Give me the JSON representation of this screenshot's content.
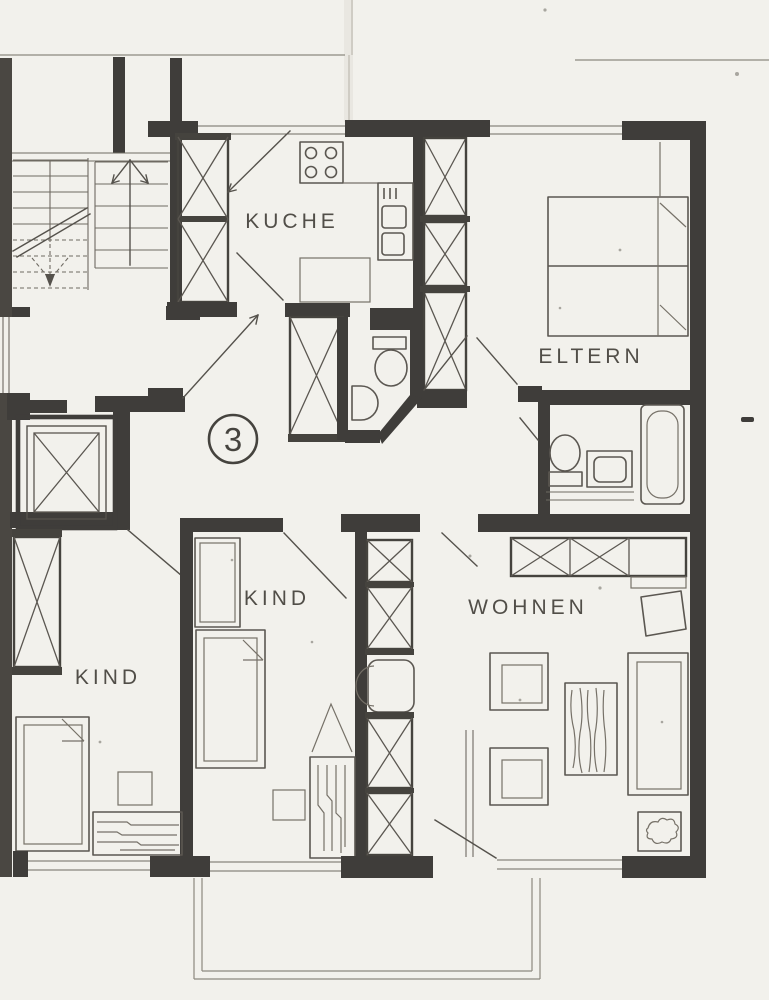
{
  "floorplan": {
    "unit_badge": "3",
    "rooms": {
      "kitchen": {
        "label": "KUCHE"
      },
      "parents": {
        "label": "ELTERN"
      },
      "child_left": {
        "label": "KIND"
      },
      "child_middle": {
        "label": "KIND"
      },
      "living": {
        "label": "WOHNEN"
      }
    },
    "colors": {
      "paper": "#f2f1ec",
      "ink": "#3f3d3a",
      "ink_soft": "#55524c"
    }
  }
}
